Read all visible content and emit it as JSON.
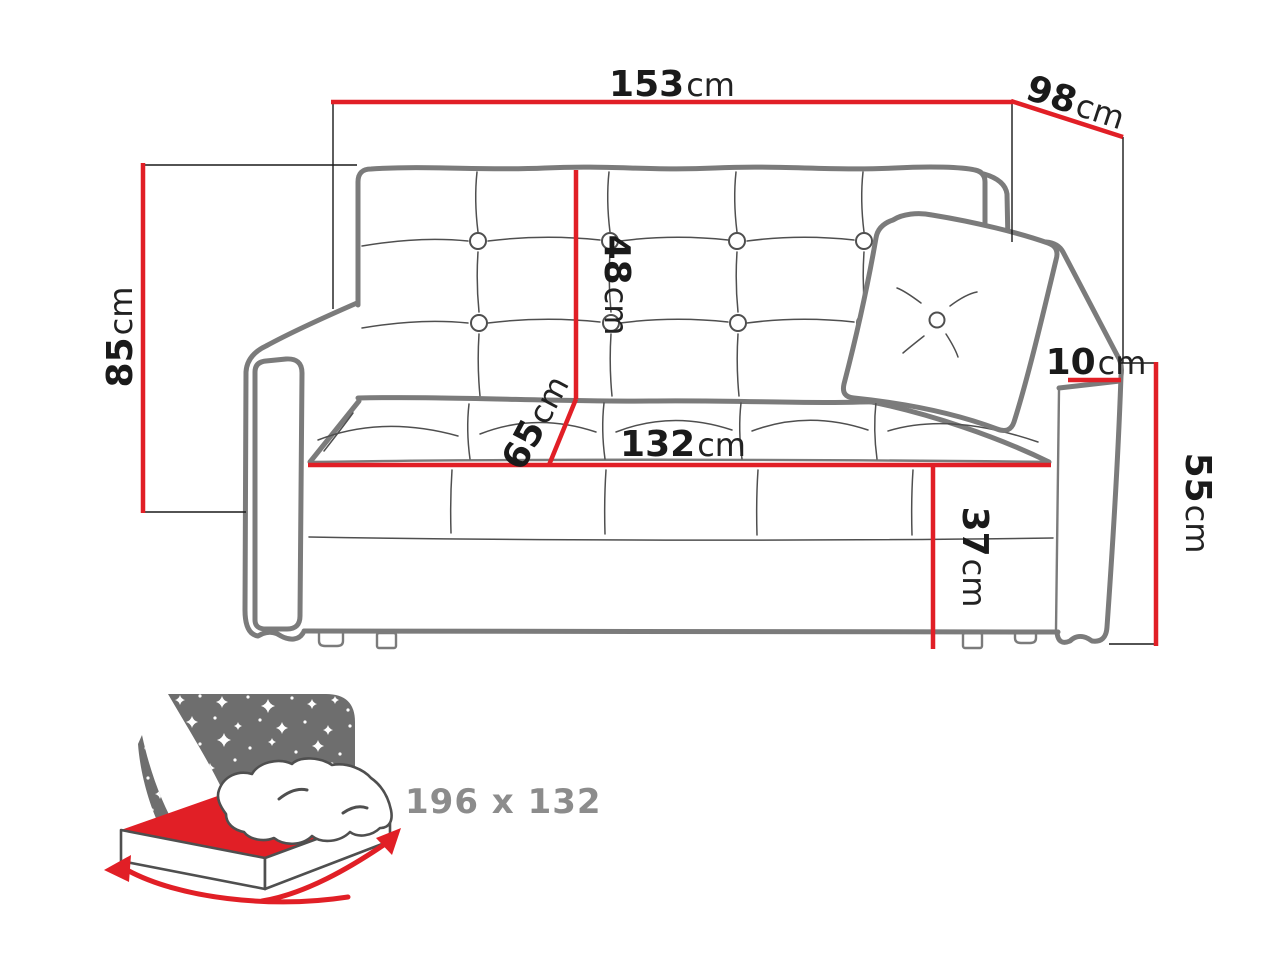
{
  "diagram": {
    "subject": "sofa-bed front view with dimension lines",
    "background": "#ffffff"
  },
  "dimension_labels": {
    "total_width": {
      "value": "153",
      "unit": "cm"
    },
    "total_depth": {
      "value": "98",
      "unit": "cm"
    },
    "total_height": {
      "value": "85",
      "unit": "cm"
    },
    "backrest_height": {
      "value": "48",
      "unit": "cm"
    },
    "seat_depth": {
      "value": "65",
      "unit": "cm"
    },
    "seat_width": {
      "value": "132",
      "unit": "cm"
    },
    "seat_height": {
      "value": "37",
      "unit": "cm"
    },
    "armrest_width": {
      "value": "10",
      "unit": "cm"
    },
    "armrest_height": {
      "value": "55",
      "unit": "cm"
    }
  },
  "sleeping_area": {
    "dimensions": "196 x 132",
    "icon": "bed-with-stars-icon"
  },
  "colors": {
    "dimension_red": "#e11f26",
    "sofa_outline_gray": "#7b7b7b",
    "seam_gray": "#4f4f4f",
    "label_text": "#1a1a1a",
    "icon_gray": "#6e6e6e",
    "sleeping_text_gray": "#8c8c8c"
  }
}
